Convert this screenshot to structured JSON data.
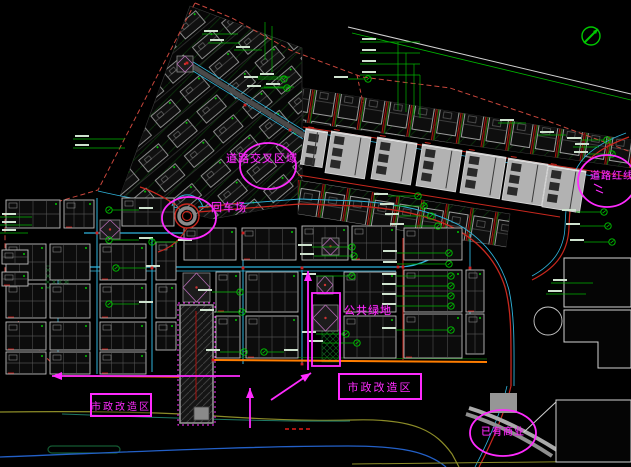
{
  "canvas": {
    "width": 631,
    "height": 467,
    "background": "#000000"
  },
  "palette": {
    "magenta": "#ff2bff",
    "green": "#00b400",
    "bright_green": "#00e000",
    "red": "#c8281e",
    "dark_red": "#aa1410",
    "boundary_red": "#c8463c",
    "cyan": "#2fb4dc",
    "blue": "#2360c8",
    "olive": "#8c8c28",
    "teal": "#1e7864",
    "orange": "#ff7d00",
    "gray_fill": "#b2b2b2",
    "outline": "#bcbcbc",
    "white": "#d2d2d2"
  },
  "annotations": {
    "road_intersection": {
      "text": "道路交叉区域",
      "x": 226,
      "y": 150,
      "size": 11
    },
    "turnaround": {
      "text": "回车场",
      "x": 211,
      "y": 199,
      "size": 11
    },
    "road_redline": {
      "text": "道路红线",
      "x": 590,
      "y": 167,
      "size": 10
    },
    "public_green": {
      "text": "公共绿地",
      "x": 344,
      "y": 302,
      "size": 11
    },
    "municipal_left": {
      "text": "市政改造区",
      "x": 90,
      "y": 393,
      "w": 58,
      "h": 20,
      "size": 10
    },
    "municipal_right": {
      "text": "市政改造区",
      "x": 338,
      "y": 373,
      "w": 80,
      "h": 23,
      "size": 11
    },
    "existing_commercial": {
      "text": "已有商业",
      "x": 481,
      "y": 423,
      "size": 10
    }
  },
  "highlights": {
    "ellipses": [
      {
        "name": "road-intersection-ellipse",
        "cx": 268,
        "cy": 166,
        "rx": 28,
        "ry": 23
      },
      {
        "name": "turnaround-ellipse",
        "cx": 189,
        "cy": 218,
        "rx": 27,
        "ry": 21
      },
      {
        "name": "road-redline-ellipse",
        "cx": 607,
        "cy": 181,
        "rx": 29,
        "ry": 26
      },
      {
        "name": "existing-commercial-ellipse",
        "cx": 503,
        "cy": 433,
        "rx": 33,
        "ry": 23
      }
    ],
    "rects": [
      {
        "name": "public-green-rect",
        "x": 312,
        "y": 293,
        "w": 28,
        "h": 73
      }
    ],
    "arrows": [
      {
        "name": "up-arrow-center",
        "x1": 308,
        "y1": 370,
        "x2": 308,
        "y2": 271
      },
      {
        "name": "up-arrow-bottom",
        "x1": 250,
        "y1": 428,
        "x2": 250,
        "y2": 388
      },
      {
        "name": "diag-arrow",
        "x1": 271,
        "y1": 400,
        "x2": 311,
        "y2": 373
      },
      {
        "name": "left-arrow",
        "x1": 240,
        "y1": 376,
        "x2": 52,
        "y2": 376
      }
    ],
    "marks": [
      [
        594,
        184,
        602,
        188
      ],
      [
        596,
        190,
        603,
        193
      ]
    ]
  },
  "compass": {
    "cx": 591,
    "cy": 36,
    "r": 9
  },
  "plan": {
    "boundary": [
      {
        "pts": "195,3 98,190 60,201 5,214 5,282 22,332 64,376",
        "color": "#c8463c",
        "w": 1,
        "dash": "5,3"
      },
      {
        "pts": "195,3 232,18 290,50 346,71 362,77 450,88 545,120 631,152",
        "color": "#c8463c",
        "w": 1,
        "dash": "5,3"
      },
      {
        "pts": "357,75 363,103",
        "color": "#c8463c",
        "w": 1,
        "dash": "4,3"
      },
      {
        "pts": "348,27 631,94",
        "color": "#d2d2d2",
        "w": 1,
        "dash": ""
      },
      {
        "pts": "352,33 631,100",
        "color": "#00b400",
        "w": 0.8,
        "dash": ""
      }
    ],
    "clusters": [
      {
        "name": "diagonal-cluster",
        "poly": "190,6 302,48 302,190 283,206 213,219 120,196",
        "pattern": "cellsA"
      },
      {
        "name": "row-band-upper",
        "poly": "303,88 631,140 631,168 303,122",
        "pattern": "cellsB"
      },
      {
        "name": "row-band-lower",
        "poly": "298,180 510,214 506,247 298,214",
        "pattern": "cellsB"
      }
    ],
    "roads": [
      [
        "M60,267 L398,267 C420,267 440,256 455,241",
        "#2fb4dc",
        1.3,
        ""
      ],
      [
        "M60,271 L396,271",
        "#2fb4dc",
        0.7,
        ""
      ],
      [
        "M84,233 L192,233",
        "#2fb4dc",
        1.2,
        ""
      ],
      [
        "M97,198 L97,374",
        "#2fb4dc",
        1,
        ""
      ],
      [
        "M152,238 L152,372",
        "#2fb4dc",
        1,
        ""
      ],
      [
        "M58,246 L58,370",
        "#2fb4dc",
        0.8,
        ""
      ],
      [
        "M243,234 L243,364",
        "#2fb4dc",
        1,
        ""
      ],
      [
        "M302,270 L302,364",
        "#2fb4dc",
        1,
        ""
      ],
      [
        "M470,234 L470,330",
        "#2fb4dc",
        0.9,
        ""
      ],
      [
        "M403,238 L403,360",
        "#c8281e",
        1,
        ""
      ],
      [
        "M198,212 L300,204 L358,206 C402,209 432,217 454,228 C480,242 497,262 505,287 C512,312 511,340 511,386",
        "#c8281e",
        1.3,
        ""
      ],
      [
        "M198,207 L300,199 L358,201 C404,204 436,213 459,225 C486,241 502,264 509,290 C515,318 514,348 514,386",
        "#2fb4dc",
        0.9,
        ""
      ],
      [
        "M178,208 C152,201 122,197 98,191",
        "#2fb4dc",
        0.9,
        ""
      ],
      [
        "M187,63 L305,136",
        "#4a4a4a",
        5,
        ""
      ],
      [
        "M185,66 L303,139",
        "#2fb4dc",
        0.8,
        ""
      ],
      [
        "M190,60 L308,133",
        "#2fb4dc",
        0.8,
        ""
      ],
      [
        "M303,127 L631,177",
        "#c8281e",
        1,
        ""
      ],
      [
        "M303,131 L600,177",
        "#2fb4dc",
        0.7,
        ""
      ],
      [
        "M298,175 L560,217",
        "#c8281e",
        1,
        ""
      ],
      [
        "M629,137 C602,147 589,157 582,169 C574,182 570,198 569,227 C568,256 552,270 532,280",
        "#c8281e",
        1.2,
        ""
      ],
      [
        "M626,133 C599,143 585,154 578,166 C570,179 566,198 565,227 C564,252 550,266 532,276",
        "#2fb4dc",
        0.8,
        ""
      ],
      [
        "M213,360 L487,362",
        "#ff7d00",
        2,
        ""
      ],
      [
        "M213,357 L487,359",
        "#0a7a0a",
        0.7,
        ""
      ],
      [
        "M64,376 L179,377",
        "#e06400",
        1.4,
        ""
      ],
      [
        "M511,386 C505,412 492,442 479,467",
        "#c8281e",
        1.2,
        ""
      ],
      [
        "M507,386 C501,412 488,442 475,467",
        "#2fb4dc",
        0.8,
        ""
      ],
      [
        "M0,412 C90,411 150,412 200,415 C270,420 320,421 352,420 C416,418 436,432 452,454 L459,467",
        "#8c8c28",
        1.2,
        ""
      ],
      [
        "M62,414 C170,418 280,422 350,421",
        "#1e7864",
        1,
        ""
      ],
      [
        "M0,457 C130,452 250,446 348,446 C402,446 428,452 446,467",
        "#2360c8",
        1.3,
        ""
      ],
      [
        "M352,464 L631,461",
        "#8c8c28",
        1,
        ""
      ],
      [
        "M285,429 L313,429",
        "#aa1410",
        2,
        "4,3"
      ],
      [
        "M469,408 C498,417 530,433 557,450",
        "#aaaaaa",
        4,
        ""
      ],
      [
        "M466,414 C495,423 526,439 552,456",
        "#8f8f8f",
        4,
        ""
      ]
    ],
    "left_block": [
      [
        6,
        200,
        54,
        28
      ],
      [
        64,
        200,
        30,
        28
      ],
      [
        122,
        198,
        52,
        28
      ],
      [
        6,
        244,
        40,
        36
      ],
      [
        50,
        244,
        40,
        36
      ],
      [
        100,
        244,
        46,
        36
      ],
      [
        156,
        242,
        20,
        38
      ],
      [
        6,
        284,
        40,
        34
      ],
      [
        50,
        284,
        40,
        34
      ],
      [
        100,
        284,
        46,
        34
      ],
      [
        156,
        284,
        20,
        34
      ],
      [
        6,
        322,
        40,
        28
      ],
      [
        50,
        322,
        40,
        28
      ],
      [
        100,
        322,
        46,
        28
      ],
      [
        156,
        322,
        20,
        28
      ],
      [
        6,
        352,
        40,
        22
      ],
      [
        50,
        352,
        40,
        22
      ],
      [
        100,
        352,
        46,
        22
      ],
      [
        2,
        250,
        26,
        14
      ],
      [
        2,
        272,
        26,
        14
      ]
    ],
    "center_block": [
      [
        184,
        228,
        52,
        32
      ],
      [
        242,
        228,
        54,
        32
      ],
      [
        302,
        226,
        46,
        34
      ],
      [
        352,
        226,
        44,
        34
      ],
      [
        404,
        228,
        58,
        32
      ],
      [
        216,
        272,
        24,
        40
      ],
      [
        246,
        272,
        52,
        40
      ],
      [
        344,
        272,
        52,
        40
      ],
      [
        404,
        270,
        58,
        42
      ],
      [
        466,
        270,
        18,
        42
      ],
      [
        216,
        316,
        24,
        42
      ],
      [
        246,
        316,
        52,
        42
      ],
      [
        344,
        316,
        52,
        42
      ],
      [
        404,
        314,
        58,
        44
      ],
      [
        466,
        314,
        18,
        40
      ]
    ],
    "slabs": [
      [
        303,
        130,
        22,
        36
      ],
      [
        328,
        134,
        40,
        42
      ],
      [
        374,
        140,
        40,
        42
      ],
      [
        419,
        147,
        40,
        42
      ],
      [
        463,
        154,
        40,
        42
      ],
      [
        505,
        161,
        40,
        42
      ],
      [
        545,
        168,
        38,
        42
      ]
    ],
    "white_buildings": [
      "564,258 631,258 631,307 564,307",
      "564,310 631,310 631,368 598,368 598,342 564,342",
      "556,400 631,400 631,462 556,462"
    ],
    "white_lines": [
      [
        524,
        432,
        556,
        402
      ]
    ],
    "gray_rects": [
      [
        490,
        393,
        27,
        20
      ]
    ],
    "plaza_circle": {
      "cx": 548,
      "cy": 321,
      "r": 14
    },
    "plazas": [
      [
        177,
        56,
        16,
        16
      ],
      [
        100,
        220,
        20,
        19
      ],
      [
        183,
        273,
        27,
        29
      ],
      [
        313,
        305,
        25,
        26
      ],
      [
        317,
        276,
        16,
        18
      ],
      [
        322,
        238,
        17,
        17
      ]
    ],
    "hatch_tower": {
      "x": 180,
      "y": 305,
      "w": 33,
      "h": 118
    },
    "roundabout": {
      "cx": 187,
      "cy": 216,
      "r_outer": 12,
      "r_inner": 4.5
    },
    "green_areas": [
      [
        46,
        266,
        22,
        22
      ],
      [
        322,
        330,
        17,
        32
      ]
    ],
    "green_lozenge": {
      "x": 48,
      "y": 446,
      "w": 72,
      "h": 7
    },
    "tags": [
      [
        204,
        30,
        34
      ],
      [
        210,
        39,
        30
      ],
      [
        236,
        46,
        26
      ],
      [
        260,
        73,
        30
      ],
      [
        266,
        83,
        28
      ],
      [
        75,
        135,
        50
      ],
      [
        75,
        144,
        50
      ],
      [
        362,
        38,
        58
      ],
      [
        362,
        49,
        58
      ],
      [
        362,
        60,
        58
      ],
      [
        362,
        71,
        58
      ],
      [
        2,
        213,
        30
      ],
      [
        2,
        221,
        30
      ],
      [
        2,
        229,
        26
      ],
      [
        553,
        279,
        40
      ],
      [
        548,
        290,
        38
      ],
      [
        500,
        119,
        26
      ],
      [
        540,
        131,
        26
      ],
      [
        575,
        143,
        24
      ]
    ],
    "ctags": [
      [
        449,
        253,
        -52
      ],
      [
        449,
        264,
        -52
      ],
      [
        451,
        276,
        -55
      ],
      [
        451,
        286,
        -55
      ],
      [
        451,
        296,
        -55
      ],
      [
        451,
        306,
        -55
      ],
      [
        451,
        330,
        -55
      ],
      [
        284,
        79,
        -26
      ],
      [
        287,
        88,
        -26
      ],
      [
        368,
        79,
        -20
      ],
      [
        418,
        196,
        -30
      ],
      [
        424,
        206,
        -30
      ],
      [
        431,
        216,
        -32
      ],
      [
        438,
        226,
        -34
      ],
      [
        109,
        210,
        30
      ],
      [
        109,
        240,
        30
      ],
      [
        116,
        268,
        30
      ],
      [
        109,
        304,
        30
      ],
      [
        152,
        242,
        26
      ],
      [
        352,
        247,
        -40
      ],
      [
        354,
        256,
        -40
      ],
      [
        352,
        276,
        -36
      ],
      [
        346,
        334,
        -30
      ],
      [
        357,
        343,
        -34
      ],
      [
        240,
        292,
        -28
      ],
      [
        242,
        312,
        -28
      ],
      [
        244,
        352,
        -24
      ],
      [
        264,
        352,
        20
      ],
      [
        607,
        140,
        -26
      ],
      [
        612,
        154,
        -24
      ],
      [
        604,
        212,
        -28
      ],
      [
        608,
        226,
        -28
      ],
      [
        612,
        242,
        -28
      ]
    ],
    "drops": [
      [
        398,
        42,
        110
      ],
      [
        406,
        53,
        112
      ],
      [
        414,
        64,
        115
      ],
      [
        420,
        75,
        118
      ],
      [
        265,
        22,
        60
      ],
      [
        272,
        26,
        72
      ]
    ],
    "red_dots": [
      [
        187,
        63
      ],
      [
        243,
        233
      ],
      [
        302,
        268
      ],
      [
        97,
        233
      ],
      [
        152,
        268
      ],
      [
        403,
        267
      ],
      [
        470,
        268
      ],
      [
        243,
        268
      ],
      [
        302,
        364
      ],
      [
        213,
        360
      ],
      [
        398,
        267
      ],
      [
        245,
        105
      ],
      [
        290,
        130
      ]
    ]
  }
}
